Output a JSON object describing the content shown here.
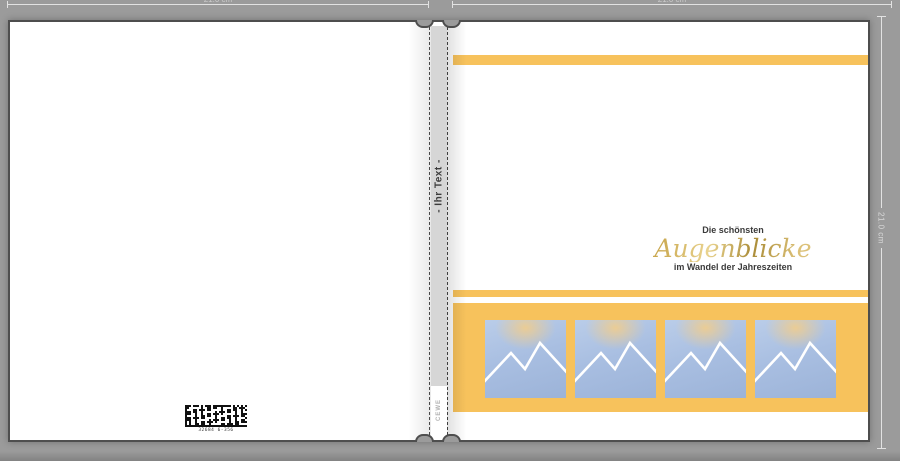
{
  "rulers": {
    "top_left_label": "21.0 cm",
    "top_right_label": "21.0 cm",
    "right_label": "21.0 cm"
  },
  "spine": {
    "placeholder_text": "- Ihr Text -",
    "brand": "CEWE"
  },
  "back_cover": {
    "barcode_caption": "32684 6-356"
  },
  "front_cover": {
    "title_line1": "Die schönsten",
    "title_script": "Augenblicke",
    "title_line3": "im Wandel der Jahreszeiten",
    "accent_color": "#F7C25C",
    "photo_placeholder_count": 4
  }
}
